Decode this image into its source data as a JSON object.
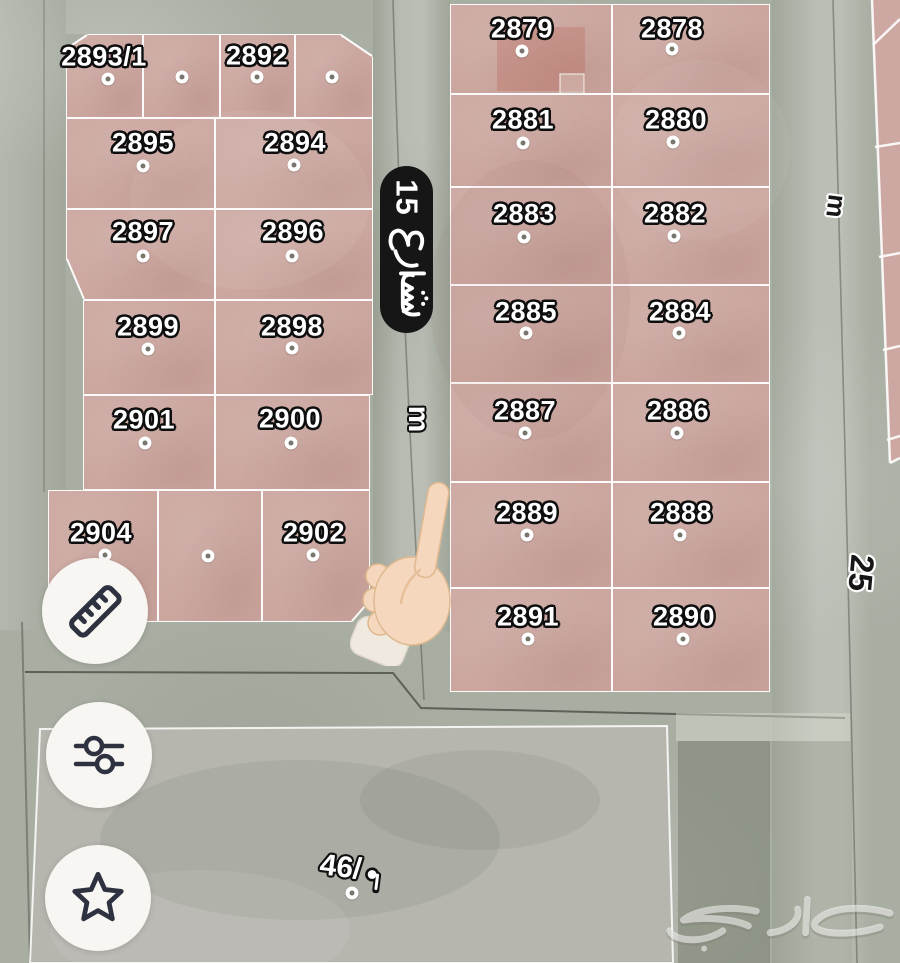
{
  "colors": {
    "plot_fill": "#cba69f",
    "street": "#a9aea3",
    "plot_border": "#ffffff",
    "street_sign_bg": "#161616",
    "street_sign_text": "#ffffff",
    "button_bg": "#f8f6f2",
    "button_icon": "#2e3240",
    "plot_label_fill": "#ffffff",
    "plot_label_outline": "#0e0e0e"
  },
  "map": {
    "street_sign": {
      "name": "شارع 15",
      "number": "15",
      "word_ar": "شارع"
    },
    "width_labels": [
      {
        "id": "street-15-width",
        "text": "m"
      },
      {
        "id": "street-25-width",
        "text": "m"
      },
      {
        "id": "street-25-number",
        "text": "25"
      }
    ],
    "open_plot": {
      "label": "46/م",
      "number_display": "46/",
      "unit_ar": "م"
    },
    "watermark": {
      "text": "حراج"
    },
    "blocks": [
      {
        "id": "west-block",
        "plots": [
          {
            "number": "2893/1",
            "x": 66,
            "y": 34,
            "w": 77,
            "h": 84,
            "lx": 104,
            "ly": 57,
            "dx": 108,
            "dy": 79
          },
          {
            "number": "",
            "x": 143,
            "y": 34,
            "w": 77,
            "h": 84,
            "dx": 182,
            "dy": 77
          },
          {
            "number": "2892",
            "x": 220,
            "y": 34,
            "w": 75,
            "h": 84,
            "lx": 257,
            "ly": 56,
            "dx": 257,
            "dy": 77
          },
          {
            "number": "",
            "x": 295,
            "y": 34,
            "w": 78,
            "h": 84,
            "dx": 332,
            "dy": 77
          },
          {
            "number": "2895",
            "x": 66,
            "y": 118,
            "w": 149,
            "h": 91,
            "lx": 143,
            "ly": 143,
            "dx": 143,
            "dy": 166
          },
          {
            "number": "2894",
            "x": 215,
            "y": 118,
            "w": 158,
            "h": 91,
            "lx": 295,
            "ly": 143,
            "dx": 294,
            "dy": 165
          },
          {
            "number": "2897",
            "x": 66,
            "y": 209,
            "w": 149,
            "h": 91,
            "lx": 143,
            "ly": 232,
            "dx": 143,
            "dy": 256
          },
          {
            "number": "2896",
            "x": 215,
            "y": 209,
            "w": 158,
            "h": 91,
            "lx": 293,
            "ly": 232,
            "dx": 292,
            "dy": 256
          },
          {
            "number": "2899",
            "x": 83,
            "y": 300,
            "w": 132,
            "h": 95,
            "lx": 148,
            "ly": 327,
            "dx": 148,
            "dy": 349
          },
          {
            "number": "2898",
            "x": 215,
            "y": 300,
            "w": 158,
            "h": 95,
            "lx": 292,
            "ly": 327,
            "dx": 292,
            "dy": 348
          },
          {
            "number": "2901",
            "x": 83,
            "y": 395,
            "w": 132,
            "h": 95,
            "lx": 144,
            "ly": 420,
            "dx": 145,
            "dy": 443
          },
          {
            "number": "2900",
            "x": 215,
            "y": 395,
            "w": 155,
            "h": 95,
            "lx": 290,
            "ly": 419,
            "dx": 291,
            "dy": 443
          },
          {
            "number": "2904",
            "x": 48,
            "y": 490,
            "w": 110,
            "h": 132,
            "lx": 101,
            "ly": 533,
            "dx": 105,
            "dy": 555
          },
          {
            "number": "",
            "x": 158,
            "y": 490,
            "w": 104,
            "h": 132,
            "dx": 208,
            "dy": 556
          },
          {
            "number": "2902",
            "x": 262,
            "y": 490,
            "w": 108,
            "h": 132,
            "lx": 314,
            "ly": 533,
            "dx": 313,
            "dy": 555
          }
        ]
      },
      {
        "id": "east-block",
        "plots": [
          {
            "number": "2879",
            "x": 450,
            "y": 4,
            "w": 162,
            "h": 90,
            "lx": 522,
            "ly": 29,
            "dx": 522,
            "dy": 51
          },
          {
            "number": "2878",
            "x": 612,
            "y": 4,
            "w": 158,
            "h": 90,
            "lx": 672,
            "ly": 29,
            "dx": 672,
            "dy": 49
          },
          {
            "number": "2881",
            "x": 450,
            "y": 94,
            "w": 162,
            "h": 93,
            "lx": 523,
            "ly": 120,
            "dx": 523,
            "dy": 143
          },
          {
            "number": "2880",
            "x": 612,
            "y": 94,
            "w": 158,
            "h": 93,
            "lx": 676,
            "ly": 120,
            "dx": 673,
            "dy": 142
          },
          {
            "number": "2883",
            "x": 450,
            "y": 187,
            "w": 162,
            "h": 98,
            "lx": 524,
            "ly": 214,
            "dx": 524,
            "dy": 237
          },
          {
            "number": "2882",
            "x": 612,
            "y": 187,
            "w": 158,
            "h": 98,
            "lx": 675,
            "ly": 214,
            "dx": 674,
            "dy": 236
          },
          {
            "number": "2885",
            "x": 450,
            "y": 285,
            "w": 162,
            "h": 98,
            "lx": 526,
            "ly": 312,
            "dx": 526,
            "dy": 333
          },
          {
            "number": "2884",
            "x": 612,
            "y": 285,
            "w": 158,
            "h": 98,
            "lx": 680,
            "ly": 312,
            "dx": 679,
            "dy": 333
          },
          {
            "number": "2887",
            "x": 450,
            "y": 383,
            "w": 162,
            "h": 99,
            "lx": 525,
            "ly": 411,
            "dx": 525,
            "dy": 433
          },
          {
            "number": "2886",
            "x": 612,
            "y": 383,
            "w": 158,
            "h": 99,
            "lx": 678,
            "ly": 411,
            "dx": 677,
            "dy": 433
          },
          {
            "number": "2889",
            "x": 450,
            "y": 482,
            "w": 162,
            "h": 106,
            "lx": 527,
            "ly": 513,
            "dx": 527,
            "dy": 535
          },
          {
            "number": "2888",
            "x": 612,
            "y": 482,
            "w": 158,
            "h": 106,
            "lx": 681,
            "ly": 513,
            "dx": 680,
            "dy": 535
          },
          {
            "number": "2891",
            "x": 450,
            "y": 588,
            "w": 162,
            "h": 104,
            "lx": 528,
            "ly": 617,
            "dx": 528,
            "dy": 639
          },
          {
            "number": "2890",
            "x": 612,
            "y": 588,
            "w": 158,
            "h": 104,
            "lx": 684,
            "ly": 617,
            "dx": 683,
            "dy": 639
          }
        ]
      }
    ]
  },
  "toolbar": {
    "buttons": [
      {
        "id": "measure",
        "icon": "ruler-icon"
      },
      {
        "id": "filters",
        "icon": "sliders-icon"
      },
      {
        "id": "favorites",
        "icon": "star-icon"
      }
    ]
  }
}
